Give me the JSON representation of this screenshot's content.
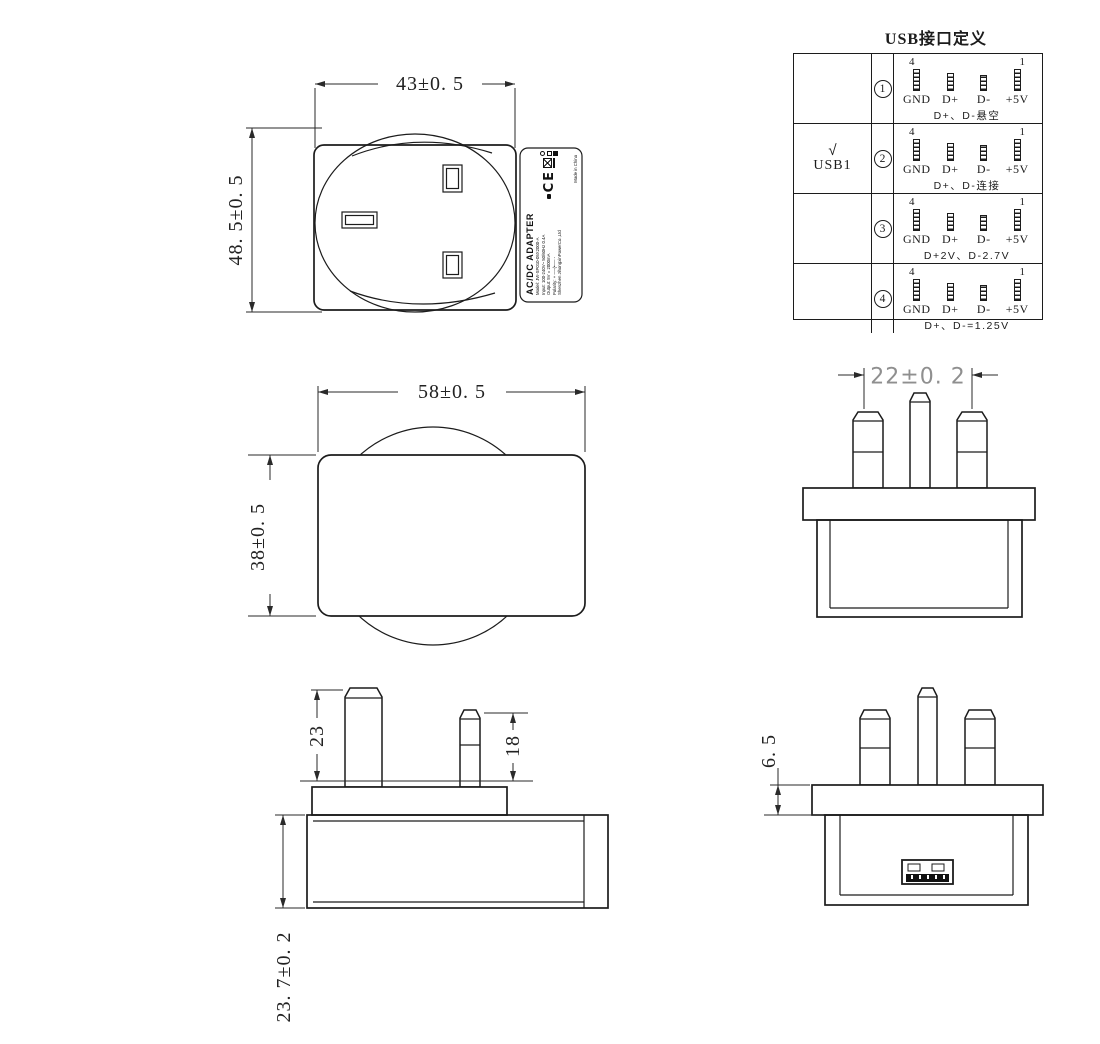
{
  "usb_table": {
    "title": "USB接口定义",
    "pin_num_left": "4",
    "pin_num_right": "1",
    "pin_labels": [
      "GND",
      "D+",
      "D-",
      "+5V"
    ],
    "rows": [
      {
        "num": "1",
        "check": "",
        "device": "",
        "note": "D+、D-悬空"
      },
      {
        "num": "2",
        "check": "√",
        "device": "USB1",
        "note": "D+、D-连接"
      },
      {
        "num": "3",
        "check": "",
        "device": "",
        "note": "D+2V、D-2.7V"
      },
      {
        "num": "4",
        "check": "",
        "device": "",
        "note": "D+、D-=1.25V"
      }
    ]
  },
  "dimensions": {
    "front_width": "43±0. 5",
    "front_height": "48. 5±0. 5",
    "side_width": "58±0. 5",
    "side_height": "38±0. 5",
    "pin_pitch": "22±0. 2",
    "earth_pin_length": "23",
    "power_pin_length": "18",
    "body_depth": "23. 7±0. 2",
    "flange_thickness": "6. 5"
  },
  "adapter_label": {
    "product": "AC/DC ADAPTER",
    "lines": [
      "Model: JW-SP010-05X2000-A",
      "Input: 100-240V~ 50/60Hz 0.4A",
      "Output: 5V = 2000mA",
      "Polarity: + ──(•── -",
      "Shenzhen JihongxinPowerCo.,Ltd"
    ],
    "ce": "CE",
    "made_in": "Made in China"
  }
}
